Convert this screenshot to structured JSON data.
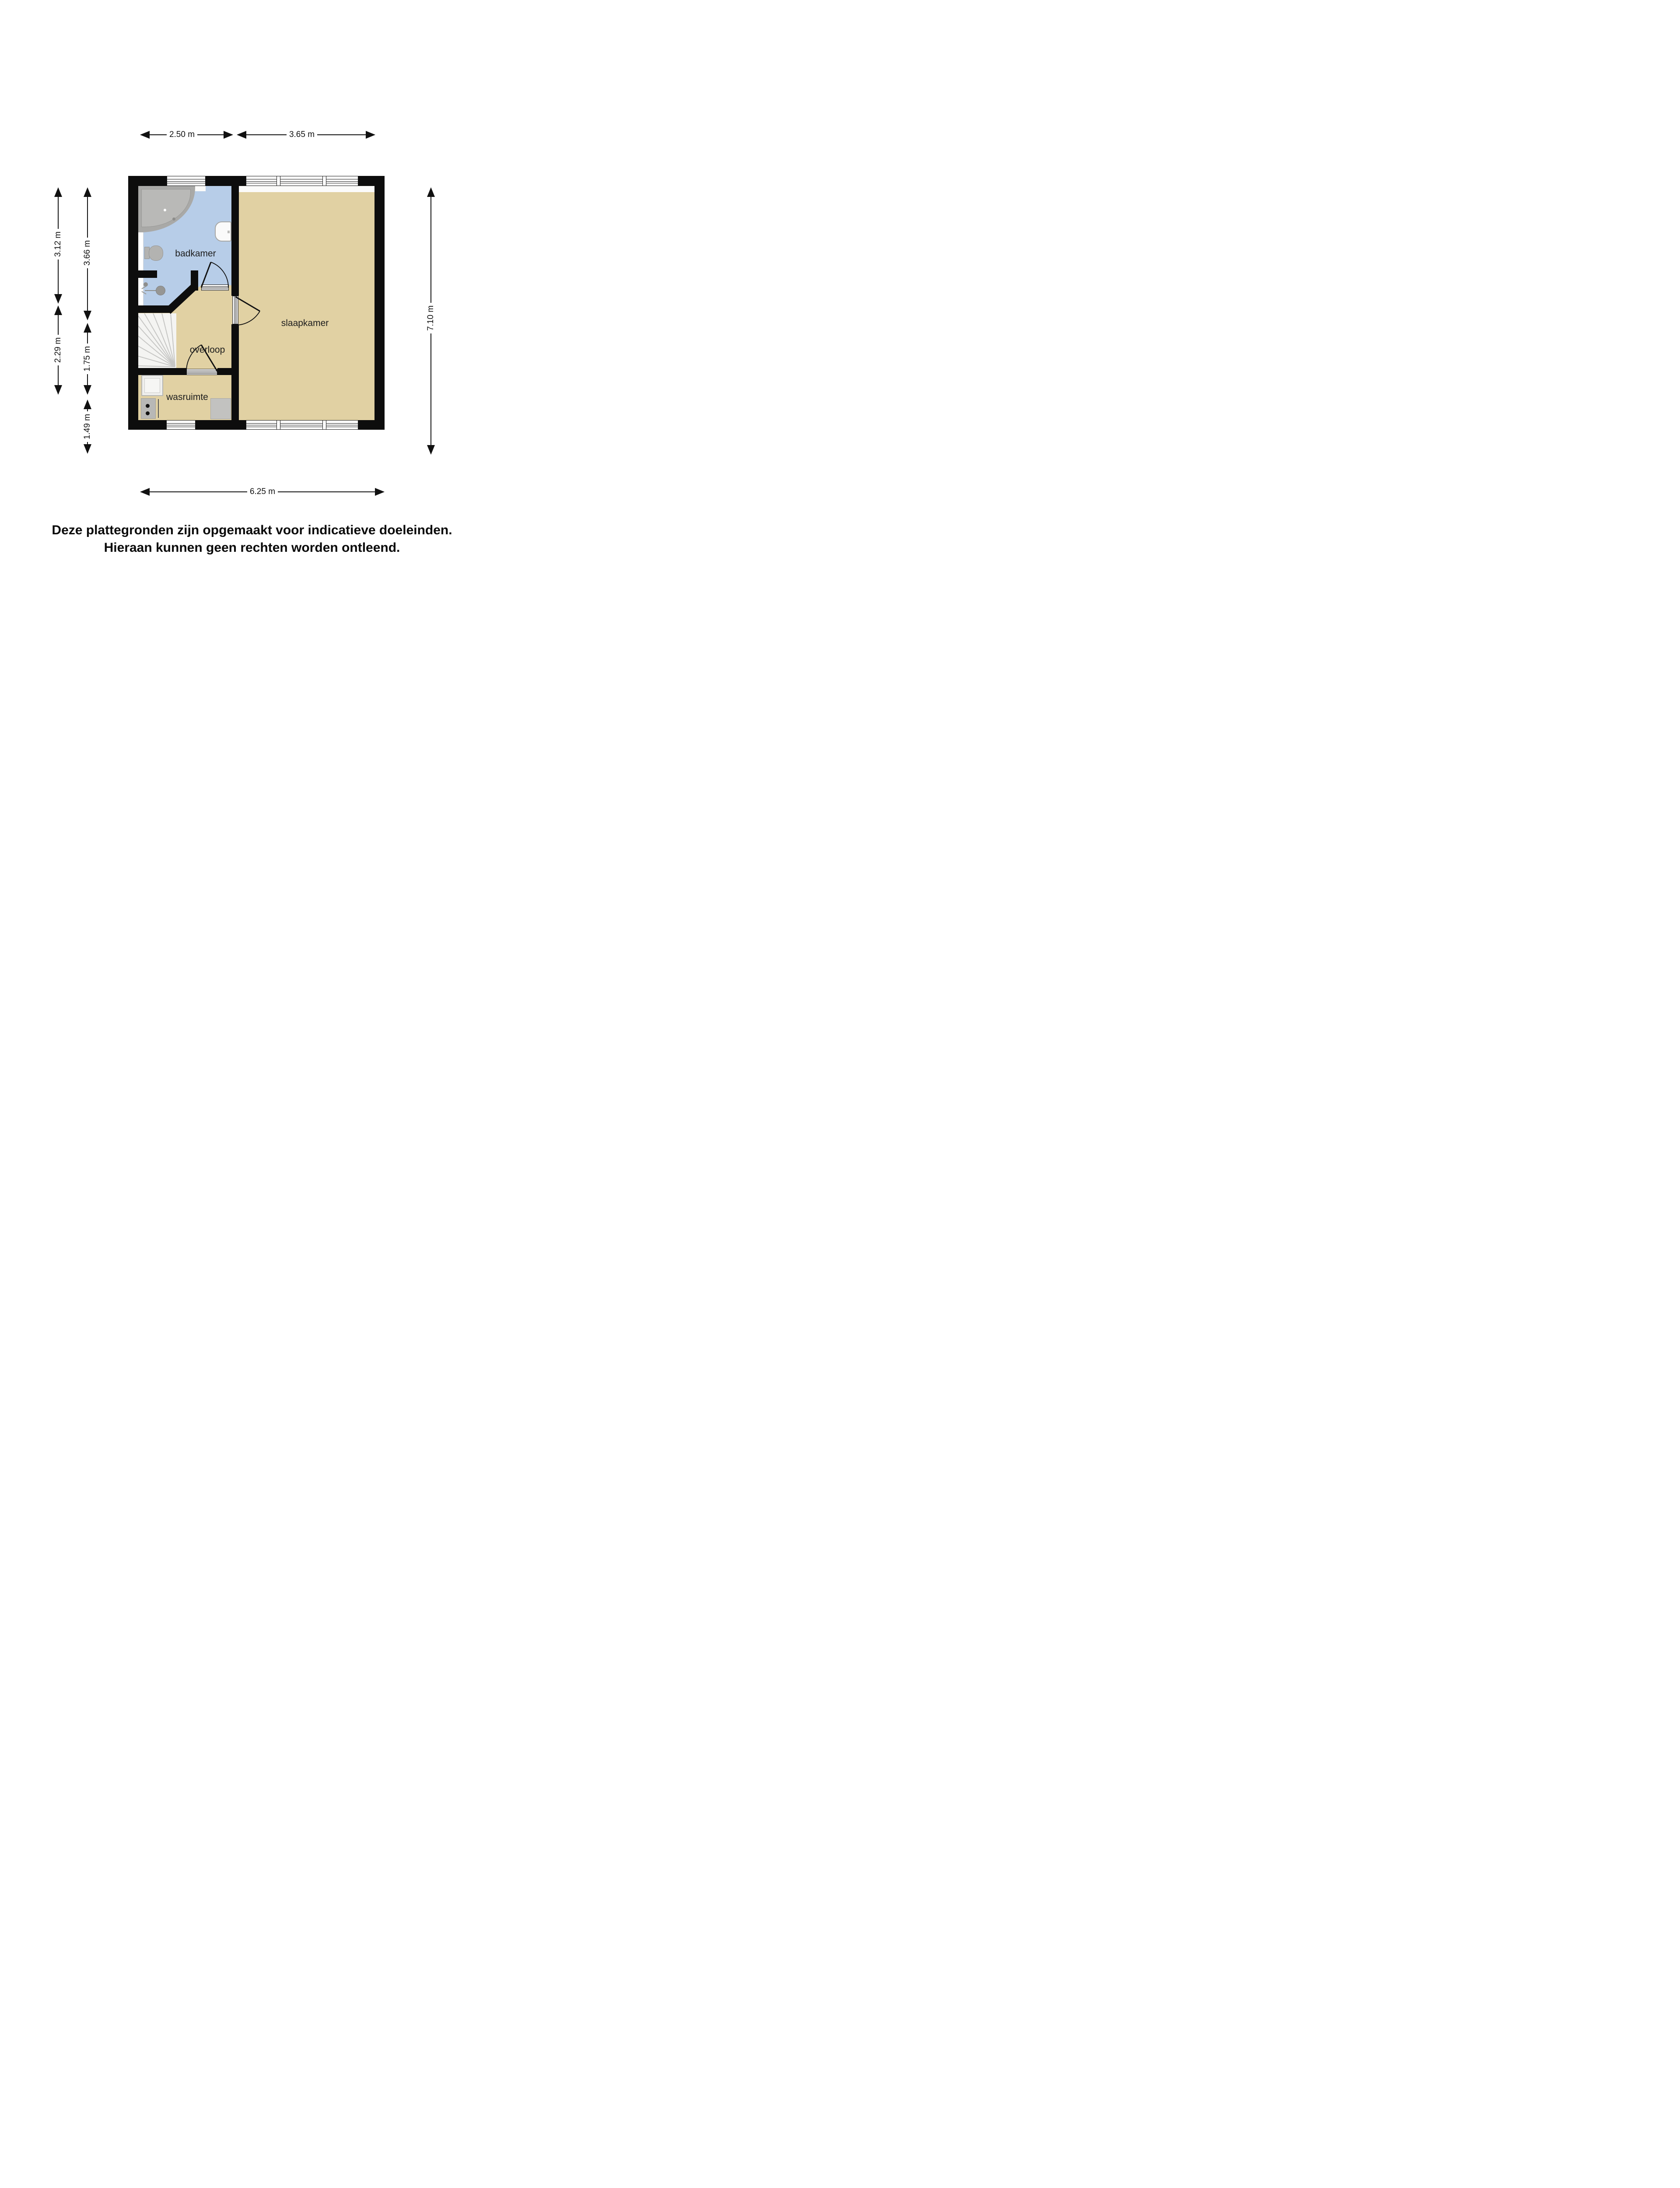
{
  "plan": {
    "rooms": [
      {
        "label": "badkamer"
      },
      {
        "label": "slaapkamer"
      },
      {
        "label": "overloop"
      },
      {
        "label": "wasruimte"
      }
    ],
    "colors": {
      "wall": "#0d0d0d",
      "bathroom_floor": "#b7cde8",
      "room_floor": "#e1d1a3",
      "stairs": "#f4f4f2",
      "fixture_gray": "#b3b3b1"
    }
  },
  "dimensions": {
    "top": [
      {
        "label": "2.50 m"
      },
      {
        "label": "3.65 m"
      }
    ],
    "left_outer": [
      {
        "label": "3.12 m"
      },
      {
        "label": "2.29 m"
      }
    ],
    "left_inner": [
      {
        "label": "3.66 m"
      },
      {
        "label": "1.75 m"
      },
      {
        "label": "1.49 m"
      }
    ],
    "right": [
      {
        "label": "7.10 m"
      }
    ],
    "bottom": [
      {
        "label": "6.25 m"
      }
    ]
  },
  "disclaimer": {
    "line1": "Deze plattegronden zijn opgemaakt voor indicatieve doeleinden.",
    "line2": "Hieraan kunnen geen rechten worden ontleend."
  }
}
